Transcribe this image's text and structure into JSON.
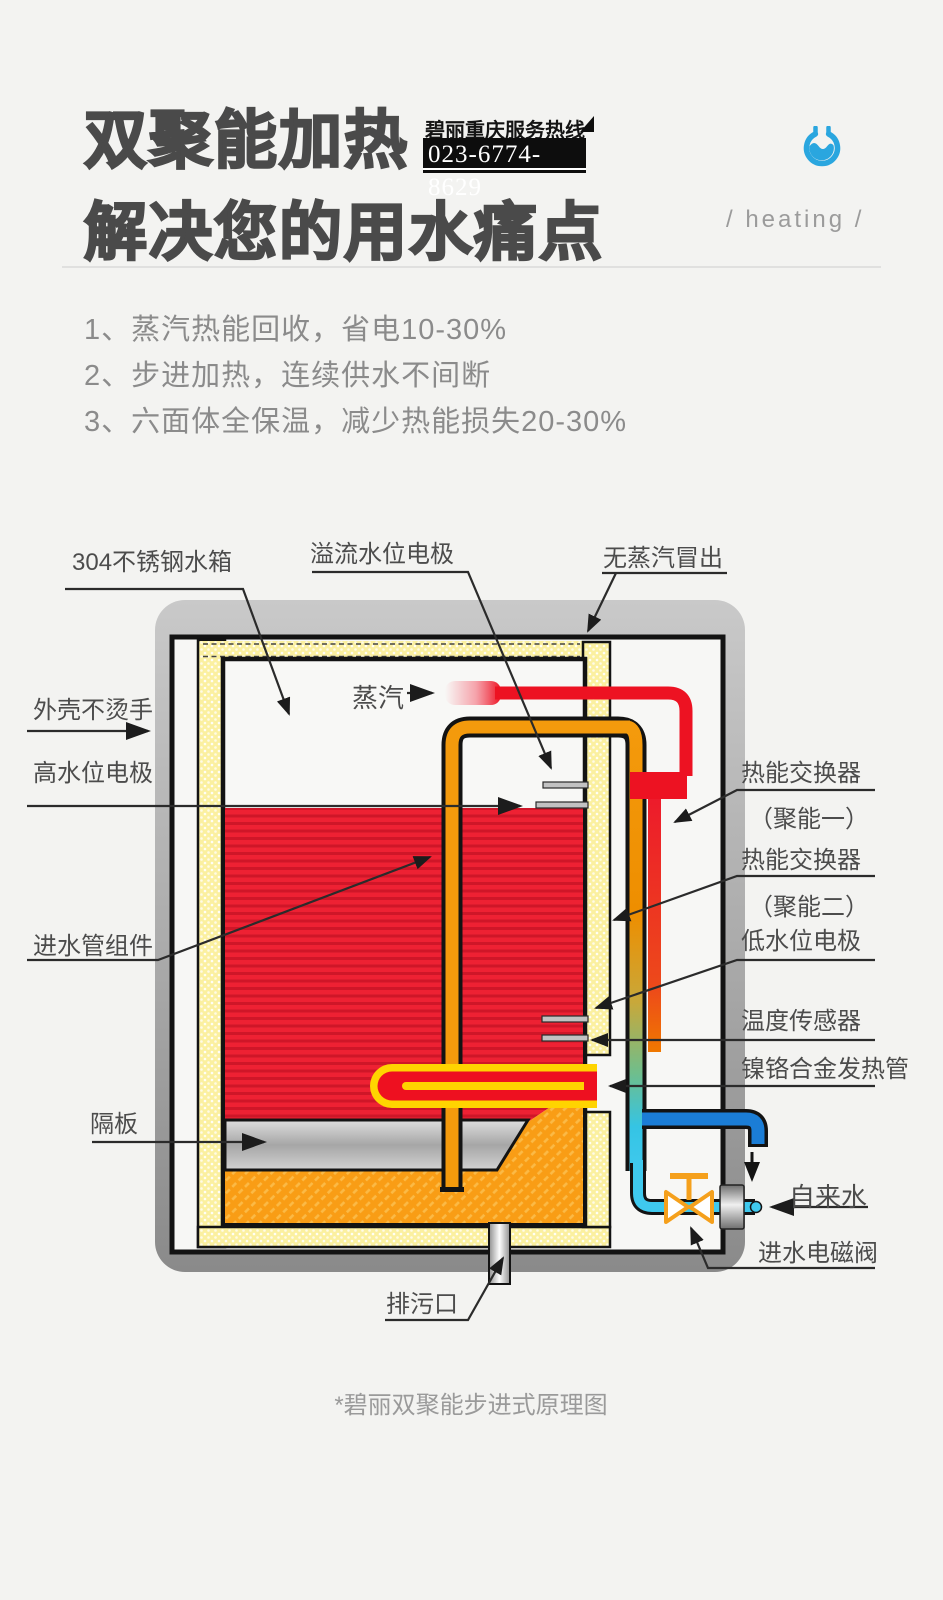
{
  "header": {
    "title_line1": "双聚能加热",
    "title_line2": "解决您的用水痛点",
    "hotline_label": "碧丽重庆服务热线",
    "hotline_number": "023-6774-8629",
    "tagline": "/ heating /",
    "logo_icon": "water-wave-logo",
    "accent_color": "#2aa6df"
  },
  "features": {
    "item1": "1、蒸汽热能回收，省电10-30%",
    "item2": "2、步进加热，连续供水不间断",
    "item3": "3、六面体全保温，减少热能损失20-30%"
  },
  "diagram": {
    "labels": {
      "tank_304": "304不锈钢水箱",
      "overflow_electrode": "溢流水位电极",
      "no_steam": "无蒸汽冒出",
      "steam": "蒸汽",
      "shell_cool": "外壳不烫手",
      "high_water_electrode": "高水位电极",
      "inlet_pipe_assembly": "进水管组件",
      "partition": "隔板",
      "drain": "排污口",
      "hx1": "热能交换器",
      "hx1_sub": "（聚能一）",
      "hx2": "热能交换器",
      "hx2_sub": "（聚能二）",
      "low_water_electrode": "低水位电极",
      "temp_sensor": "温度传感器",
      "heater_tube": "镍铬合金发热管",
      "tap_water": "自来水",
      "inlet_valve": "进水电磁阀"
    },
    "colors": {
      "hot_water": "#ee1c2e",
      "cold_water": "#3fc9ee",
      "insulation": "#fbf0a2",
      "pipe_orange": "#f49a0c",
      "valve_orange": "#f5a01c",
      "inlet_blue": "#1b7dd6",
      "shell_gray": "#a9a9a9"
    }
  },
  "caption": "*碧丽双聚能步进式原理图"
}
